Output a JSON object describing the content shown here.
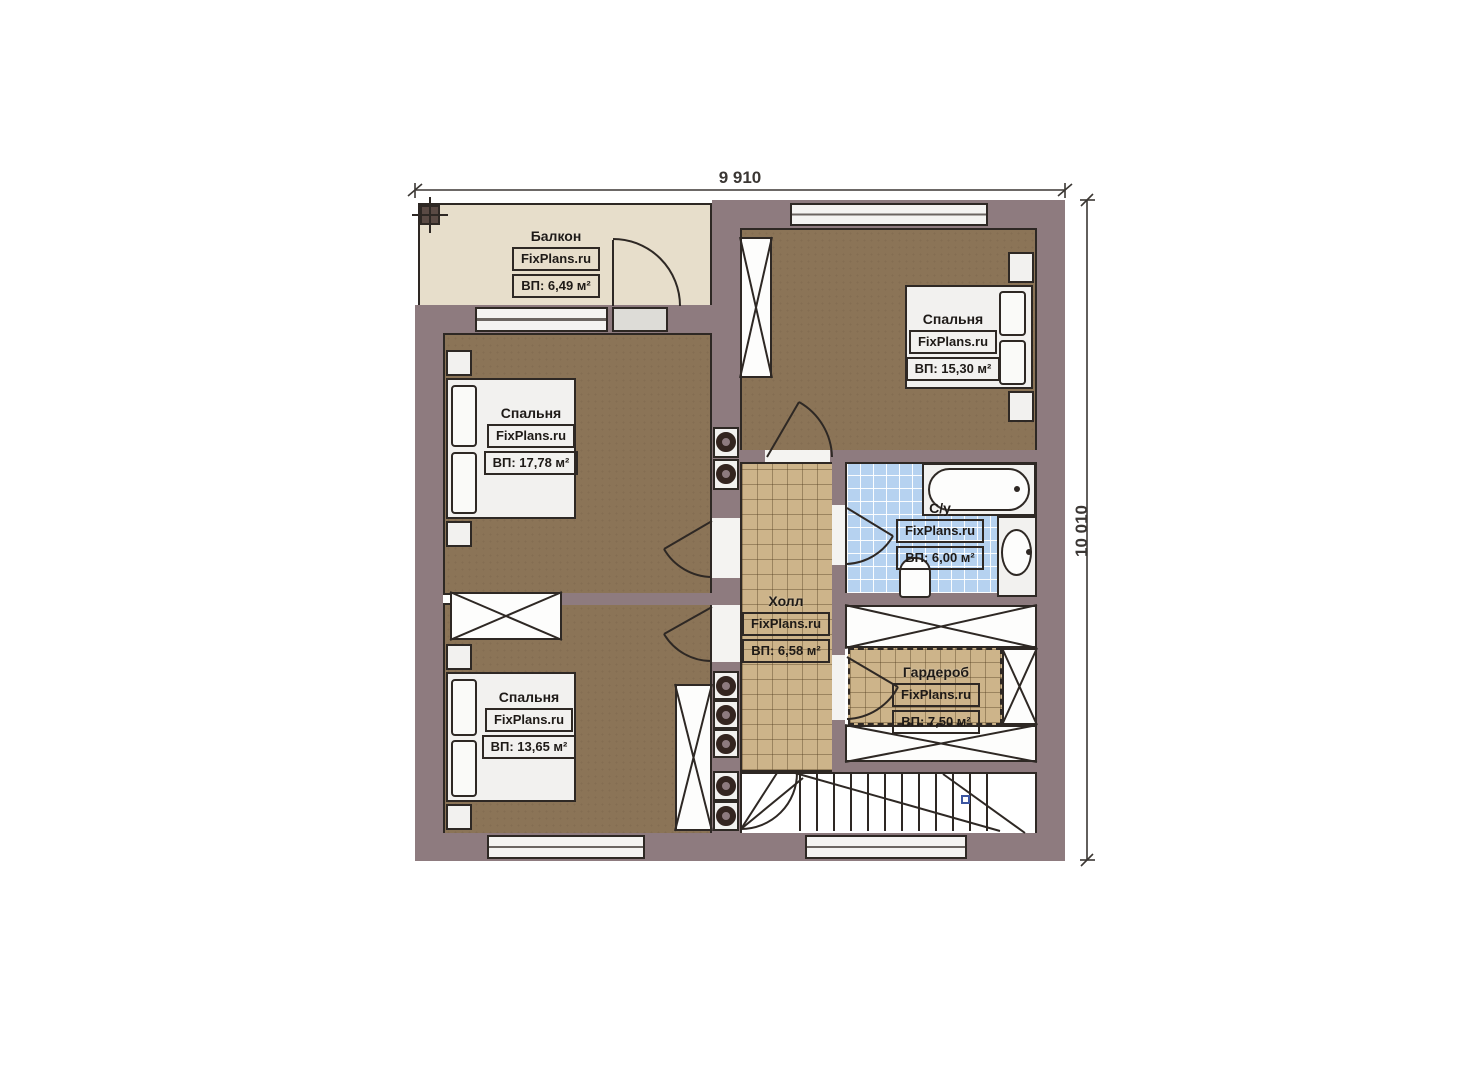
{
  "plan": {
    "dimensions": {
      "width": "9 910",
      "height": "10 010"
    },
    "rooms": {
      "balcony": {
        "name": "Балкон",
        "brand": "FixPlans.ru",
        "area": "ВП: 6,49 м²"
      },
      "bedroom_left": {
        "name": "Спальня",
        "brand": "FixPlans.ru",
        "area": "ВП: 17,78 м²"
      },
      "bedroom_right": {
        "name": "Спальня",
        "brand": "FixPlans.ru",
        "area": "ВП: 15,30 м²"
      },
      "bathroom": {
        "name": "С/у",
        "brand": "FixPlans.ru",
        "area": "ВП: 6,00 м²"
      },
      "hall": {
        "name": "Холл",
        "brand": "FixPlans.ru",
        "area": "ВП: 6,58 м²"
      },
      "wardrobe": {
        "name": "Гардероб",
        "brand": "FixPlans.ru",
        "area": "ВП: 7,50 м²"
      },
      "bedroom_bottom": {
        "name": "Спальня",
        "brand": "FixPlans.ru",
        "area": "ВП: 13,65 м²"
      }
    },
    "colors": {
      "wall": "#8e7b7f",
      "bedroom_floor": "#8b7457",
      "hall_floor": "#cdb48a",
      "bathroom_floor": "#b6d2f0",
      "balcony_floor": "#e7decb",
      "linework": "#2e2824"
    }
  }
}
